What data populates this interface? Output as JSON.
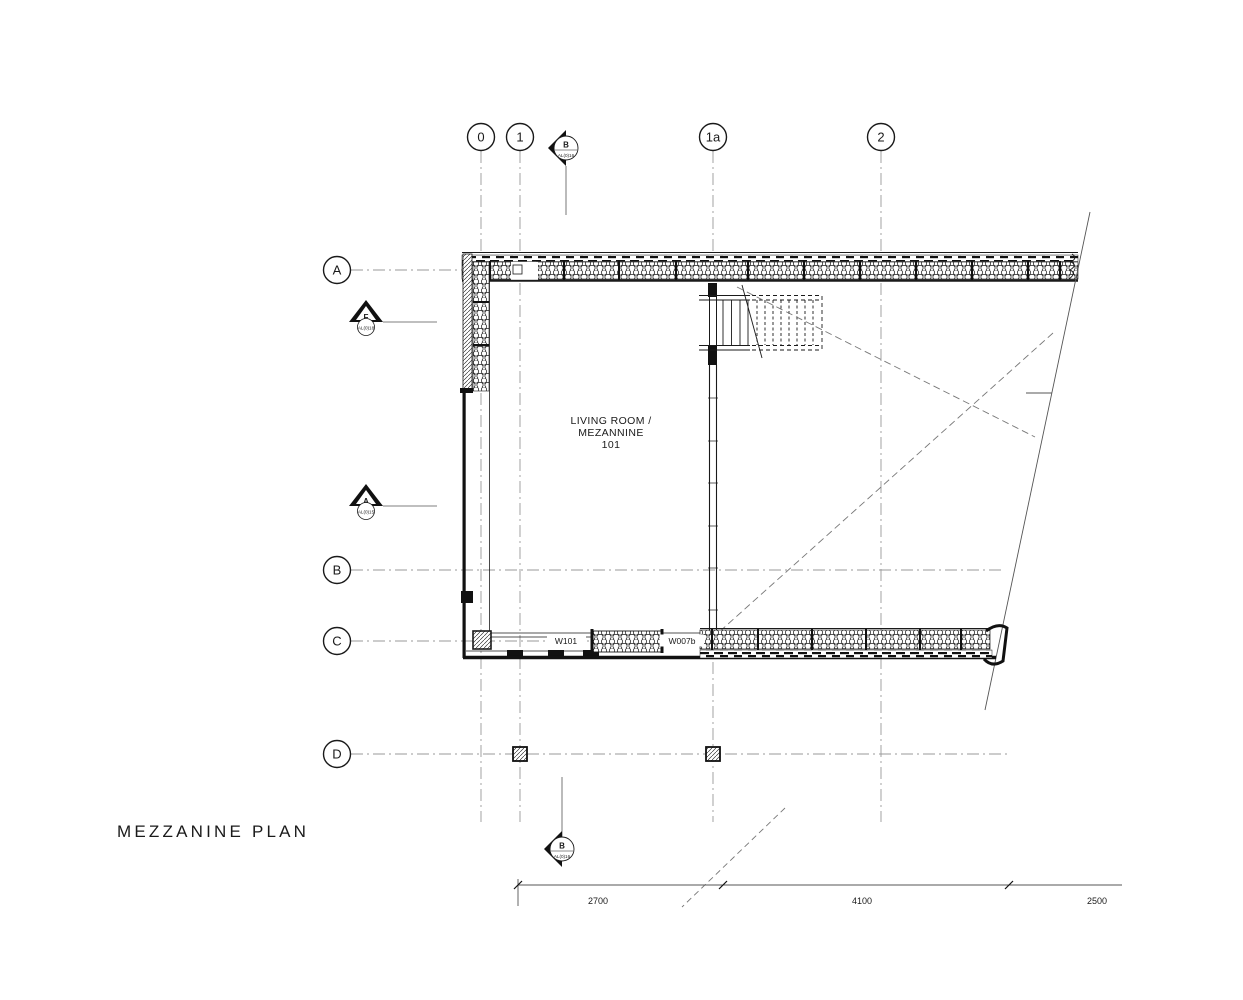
{
  "title": "MEZZANINE PLAN",
  "room": {
    "line1": "LIVING ROOM /",
    "line2": "MEZANNINE",
    "number": "101"
  },
  "grid": {
    "columns": [
      "0",
      "1",
      "1a",
      "2"
    ],
    "rows": [
      "A",
      "B",
      "C",
      "D"
    ]
  },
  "markers": {
    "section_top": {
      "letter": "B",
      "sheet": "AL(0)16"
    },
    "section_bottom": {
      "letter": "B",
      "sheet": "AL(0)16"
    },
    "elevation_f": {
      "letter": "F",
      "sheet": "AL(0)18"
    },
    "elevation_a": {
      "letter": "A",
      "sheet": "AL(0)15"
    }
  },
  "walls": {
    "w101": "W101",
    "w007b": "W007b"
  },
  "dimensions": [
    "2700",
    "4100",
    "2500"
  ],
  "colors": {
    "line": "#1a1a1a",
    "grid": "#999999",
    "bg": "#ffffff"
  }
}
